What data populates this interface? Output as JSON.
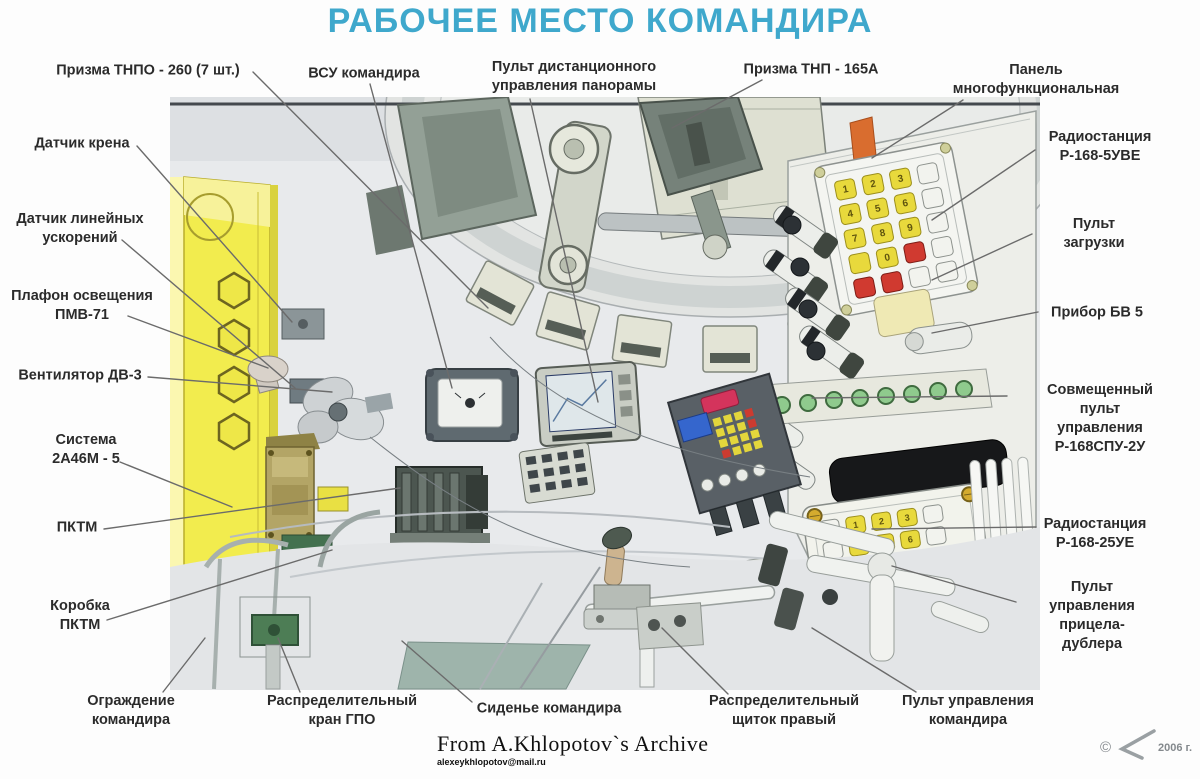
{
  "title": "РАБОЧЕЕ МЕСТО КОМАНДИРА",
  "colors": {
    "title": "#3fa8cc",
    "label_text": "#2b2b2b",
    "line": "#6b6b6b",
    "panel_yellow": "#f2ec4e",
    "key_yellow": "#e8d93c",
    "key_red": "#d03a30",
    "indicator_green": "#8fca8d",
    "accent_orange": "#d96d2f"
  },
  "keypad_digits": [
    "1",
    "2",
    "3",
    "4",
    "5",
    "6",
    "7",
    "8",
    "9",
    "0"
  ],
  "callouts": [
    {
      "id": "prizma-tnpo-260",
      "text": "Призма ТНПО - 260 (7 шт.)",
      "x": 148,
      "y": 71,
      "line": [
        253,
        72,
        488,
        308
      ]
    },
    {
      "id": "datchik-krena",
      "text": "Датчик крена",
      "x": 82,
      "y": 144,
      "line": [
        137,
        146,
        292,
        322
      ]
    },
    {
      "id": "datchik-uskoreniy",
      "text": "Датчик линейных\nускорений",
      "x": 80,
      "y": 229,
      "line": [
        122,
        240,
        295,
        388
      ]
    },
    {
      "id": "plafon-pmv71",
      "text": "Плафон освещения\nПМВ-71",
      "x": 82,
      "y": 306,
      "line": [
        128,
        316,
        268,
        368
      ]
    },
    {
      "id": "ventilyator-dv3",
      "text": "Вентилятор ДВ-3",
      "x": 80,
      "y": 376,
      "line": [
        148,
        377,
        332,
        392
      ]
    },
    {
      "id": "sistema-2a46m",
      "text": "Система\n2А46М - 5",
      "x": 86,
      "y": 450,
      "line": [
        120,
        462,
        232,
        507
      ]
    },
    {
      "id": "pktm",
      "text": "ПКТМ",
      "x": 77,
      "y": 528,
      "line": [
        104,
        529,
        400,
        488
      ]
    },
    {
      "id": "korobka-pktm",
      "text": "Коробка\nПКТМ",
      "x": 80,
      "y": 616,
      "line": [
        107,
        620,
        332,
        550
      ]
    },
    {
      "id": "ograzhdenie-komandira",
      "text": "Ограждение\nкомандира",
      "x": 131,
      "y": 711,
      "line": [
        163,
        692,
        205,
        638
      ]
    },
    {
      "id": "vsu-komandira",
      "text": "ВСУ командира",
      "x": 364,
      "y": 74,
      "line": [
        370,
        84,
        452,
        388
      ]
    },
    {
      "id": "pult-panoramy",
      "text": "Пульт дистанционного\nуправления панорамы",
      "x": 574,
      "y": 77,
      "line": [
        530,
        99,
        598,
        402
      ]
    },
    {
      "id": "prizma-tnp-165a",
      "text": "Призма ТНП - 165А",
      "x": 811,
      "y": 70,
      "line": [
        762,
        80,
        672,
        128
      ]
    },
    {
      "id": "panel-mnogofunkcionalnaya",
      "text": "Панель\nмногофункциональная",
      "x": 1036,
      "y": 80,
      "line": [
        963,
        100,
        872,
        158
      ]
    },
    {
      "id": "radio-r168-5uve",
      "text": "Радиостанция\nР-168-5УВЕ",
      "x": 1100,
      "y": 147,
      "line": [
        1035,
        150,
        932,
        220
      ]
    },
    {
      "id": "pult-zagruzki",
      "text": "Пульт загрузки",
      "x": 1094,
      "y": 234,
      "line": [
        1032,
        234,
        932,
        280
      ]
    },
    {
      "id": "pribor-bv5",
      "text": "Прибор БВ  5",
      "x": 1097,
      "y": 313,
      "line": [
        1038,
        312,
        932,
        333
      ]
    },
    {
      "id": "sovmeshchenny-pult",
      "text": "Совмещенный пульт\nуправления\nР-168СПУ-2У",
      "x": 1100,
      "y": 419,
      "line": [
        1007,
        396,
        812,
        398
      ]
    },
    {
      "id": "radio-r168-25ue",
      "text": "Радиостанция\nР-168-25УЕ",
      "x": 1095,
      "y": 534,
      "line": [
        1036,
        527,
        872,
        529
      ]
    },
    {
      "id": "pult-pritsela-dublera",
      "text": "Пульт управления\nприцела-дублера",
      "x": 1092,
      "y": 616,
      "line": [
        1016,
        602,
        892,
        566
      ]
    },
    {
      "id": "pult-upravleniya-komandira",
      "text": "Пульт управления\nкомандира",
      "x": 968,
      "y": 711,
      "line": [
        916,
        692,
        812,
        628
      ]
    },
    {
      "id": "raspred-kran-gpo",
      "text": "Распределительный\nкран  ГПО",
      "x": 342,
      "y": 711,
      "line": [
        300,
        692,
        278,
        638
      ]
    },
    {
      "id": "sidene-komandira",
      "text": "Сиденье командира",
      "x": 549,
      "y": 709,
      "line": [
        472,
        702,
        402,
        641
      ]
    },
    {
      "id": "raspred-shchitok",
      "text": "Распределительный\nщиток правый",
      "x": 784,
      "y": 711,
      "line": [
        728,
        694,
        662,
        628
      ]
    }
  ],
  "credit": {
    "line1": "From A.Khlopotov`s Archive",
    "line2": "alexeykhlopotov@mail.ru"
  },
  "copyright": {
    "symbol": "©",
    "year_text": "2006 г."
  }
}
